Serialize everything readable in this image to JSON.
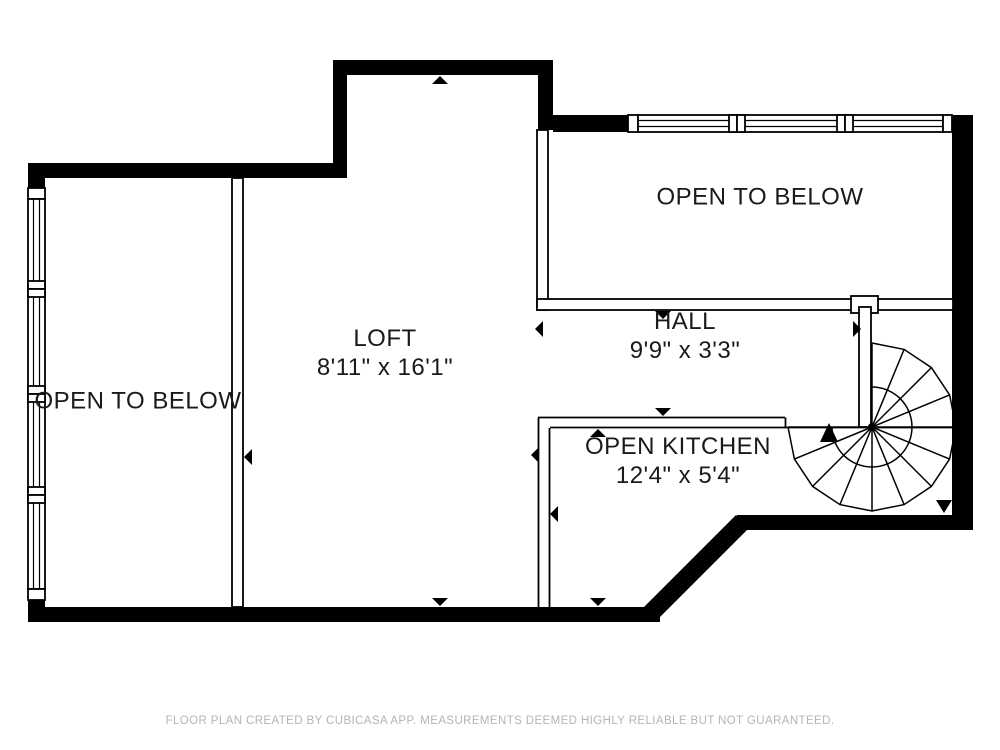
{
  "plan": {
    "rooms": [
      {
        "id": "open-to-below-left",
        "label": "OPEN TO BELOW",
        "dimensions": ""
      },
      {
        "id": "loft",
        "label": "LOFT",
        "dimensions": "8'11\" x 16'1\""
      },
      {
        "id": "open-to-below-upper",
        "label": "OPEN TO BELOW",
        "dimensions": ""
      },
      {
        "id": "hall",
        "label": "HALL",
        "dimensions": "9'9\" x 3'3\""
      },
      {
        "id": "open-kitchen",
        "label": "OPEN KITCHEN",
        "dimensions": "12'4\" x 5'4\""
      }
    ],
    "footer": "FLOOR PLAN CREATED BY CUBICASA APP. MEASUREMENTS DEEMED HIGHLY RELIABLE BUT NOT GUARANTEED.",
    "colors": {
      "wall": "#000000",
      "background": "#ffffff",
      "label_text": "#1a1a1a",
      "footer_text": "#b4b4b4"
    }
  }
}
